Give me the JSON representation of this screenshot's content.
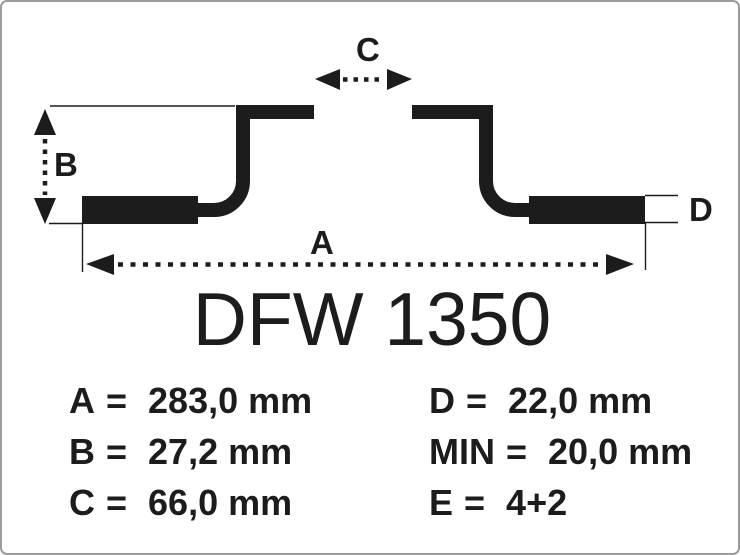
{
  "diagram": {
    "part_number": "DFW 1350",
    "type_note": "brake-disc-cross-section",
    "dimension_labels": {
      "a": "A",
      "b": "B",
      "c": "C",
      "d": "D"
    }
  },
  "specs": {
    "equals": "=",
    "left": [
      {
        "label": "A",
        "value": "283,0 mm"
      },
      {
        "label": "B",
        "value": "27,2 mm"
      },
      {
        "label": "C",
        "value": "66,0 mm"
      }
    ],
    "right": [
      {
        "label": "D",
        "value": "22,0 mm"
      },
      {
        "label": "MIN",
        "value": "20,0 mm"
      },
      {
        "label": "E",
        "value": "4+2"
      }
    ]
  },
  "colors": {
    "ink": "#1c1c1c",
    "frame_border": "#9c9c9c",
    "background": "#ffffff"
  }
}
